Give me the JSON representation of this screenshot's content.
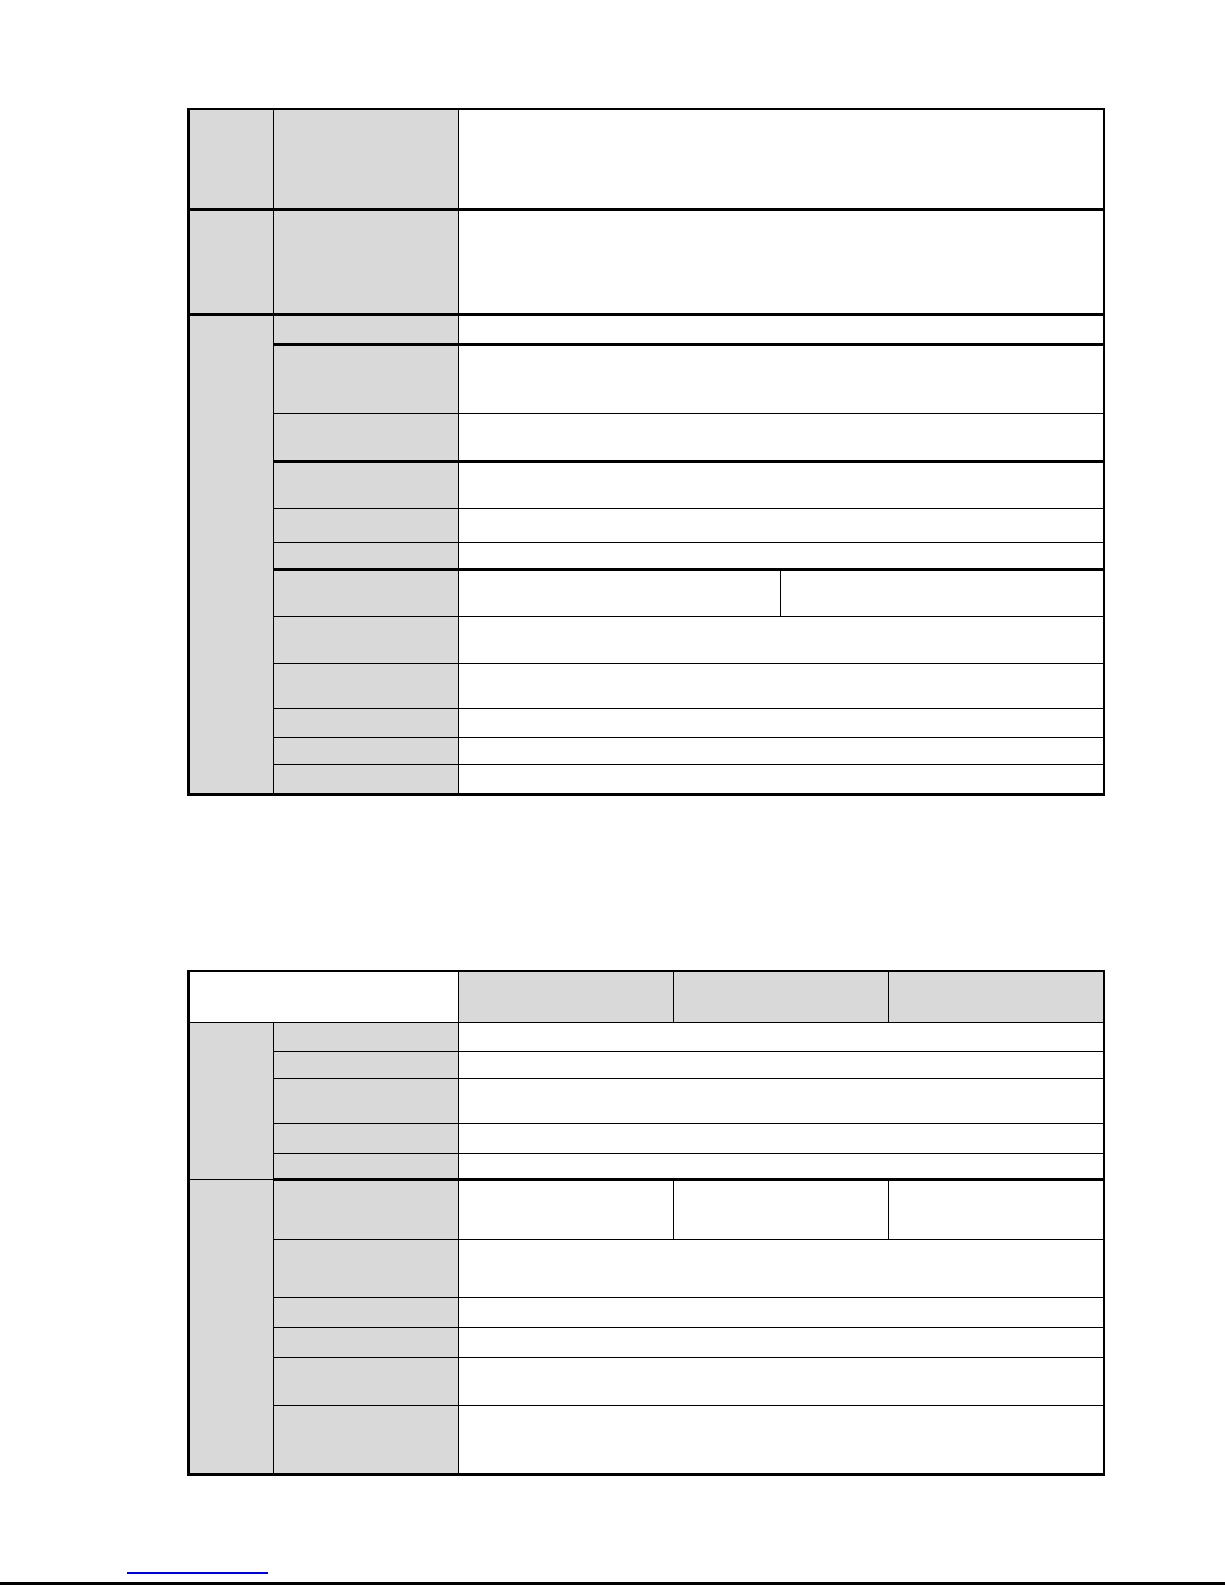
{
  "page": {
    "type": "document-page-with-empty-spec-tables",
    "background": "#ffffff"
  },
  "theme": {
    "page_background": "#ffffff",
    "table_header_fill": "#d9d9d9",
    "table_border_color": "#000000",
    "footer_link_color": "#0000cc",
    "page_rule_color": "#000000"
  },
  "table1": {
    "all_cells_empty": true,
    "group_rows": [
      "",
      "",
      ""
    ],
    "field_labels": [
      "",
      "",
      "",
      "",
      "",
      "",
      "",
      "",
      "",
      "",
      "",
      "",
      "",
      ""
    ],
    "values": [
      "",
      "",
      "",
      "",
      "",
      "",
      "",
      "",
      "",
      "",
      "",
      "",
      "",
      "",
      ""
    ]
  },
  "table2": {
    "all_cells_empty": true,
    "diagonal_header_cell": "",
    "column_headers": [
      "",
      "",
      ""
    ],
    "group_rows": [
      "",
      ""
    ],
    "field_labels": [
      "",
      "",
      "",
      "",
      "",
      "",
      "",
      "",
      "",
      "",
      ""
    ],
    "values": [
      "",
      "",
      "",
      "",
      "",
      "",
      "",
      "",
      "",
      "",
      "",
      "",
      ""
    ]
  },
  "footer": {
    "link_text": ""
  }
}
